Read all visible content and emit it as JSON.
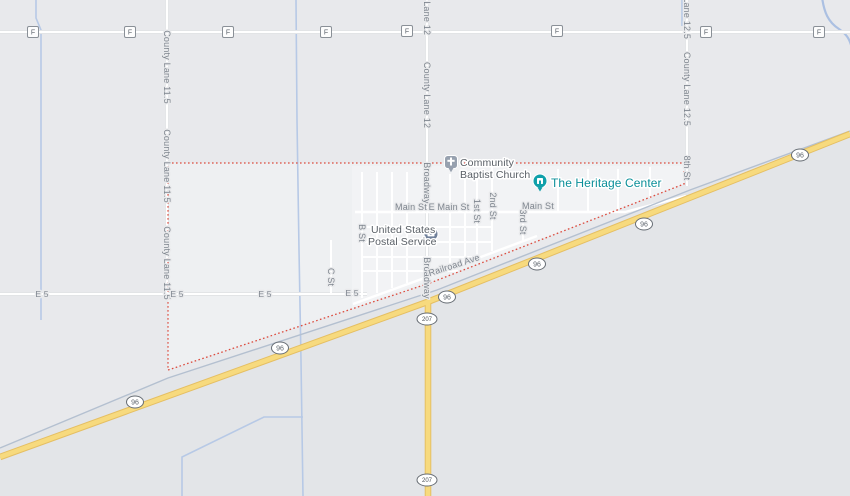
{
  "view": {
    "type": "road-map",
    "width_px": 850,
    "height_px": 496
  },
  "place_labels": {
    "church_line1": "Community",
    "church_line2": "Baptist Church",
    "post_line1": "United States",
    "post_line2": "Postal Service",
    "heritage": "The Heritage Center"
  },
  "road_labels": {
    "county_lane_11_5": "County Lane 11.5",
    "county_lane_12": "County Lane 12",
    "county_lane_12_5": "County Lane 12.5",
    "broadway": "Broadway",
    "eighth_st": "8th St",
    "b_st": "B St",
    "c_st": "C St",
    "first_st": "1st St",
    "second_st": "2nd St",
    "third_st": "3rd St",
    "main_st": "Main St",
    "e_main_st": "E Main St",
    "railroad_ave": "Railroad Ave",
    "e5": "E 5"
  },
  "shields": {
    "f": "F",
    "us96": "96",
    "r207": "207"
  },
  "colors": {
    "background": "#e8e9ec",
    "boundary_red": "#dc4b3e",
    "highway_fill": "#f7da7e",
    "highway_casing": "#e5bf63",
    "water_blue": "#b7c9e6",
    "railroad_gray": "#b4c0d0",
    "heritage_pin_teal": "#0fa0aa",
    "church_pin_gray": "#97a1af",
    "postal_pin_slate": "#70809a"
  }
}
